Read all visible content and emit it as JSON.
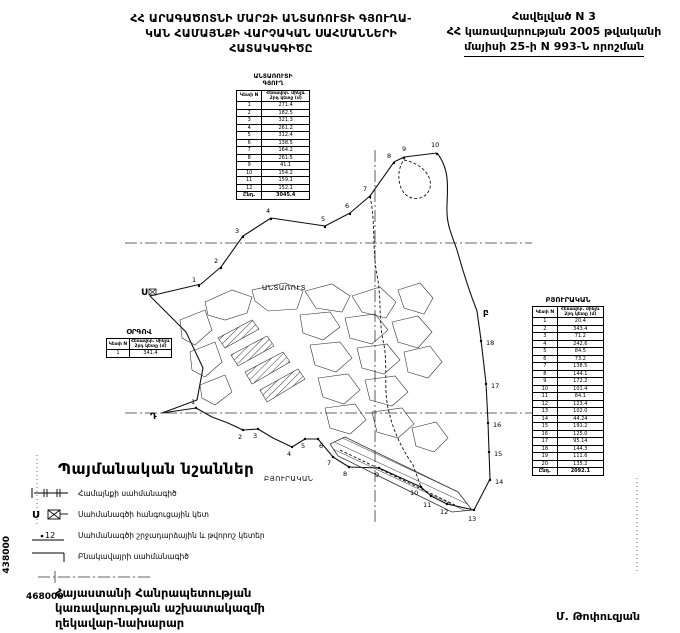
{
  "header": {
    "title_lines": [
      "ՀՀ ԱՐԱԳԱԾՈՏՆԻ ՄԱՐԶԻ ԱՆՏԱՌՈՒՏԻ ԳՅՈՒՂԱ-",
      "ԿԱՆ ՀԱՄԱՅՆՔԻ ՎԱՐՉԱԿԱՆ ՍԱՀՄԱՆՆԵՐԻ",
      "ՀԱՏԱԿԱԳԻԾԸ"
    ],
    "annex_lines": [
      "Հավելված N 3",
      "ՀՀ կառավարության 2005 թվականի",
      "մայիսի 25-ի N 993-Ն որոշման"
    ]
  },
  "tables": {
    "col_point": "Կետի N",
    "col_dist": "Հեռավոր. մինչև 2րդ կետը (մ)",
    "total_label": "Ընդ.",
    "north": {
      "title_lines": [
        "ԱՆՏԱՌՈՒՏԻ",
        "ԳՅՈՒՂ"
      ],
      "rows": [
        [
          "1",
          "271.4"
        ],
        [
          "2",
          "182.5"
        ],
        [
          "3",
          "321.3"
        ],
        [
          "4",
          "261.2"
        ],
        [
          "5",
          "312.4"
        ],
        [
          "6",
          "138.5"
        ],
        [
          "7",
          "164.2"
        ],
        [
          "8",
          "261.5"
        ],
        [
          "9",
          "41.1"
        ],
        [
          "10",
          "154.2"
        ],
        [
          "11",
          "159.1"
        ],
        [
          "12",
          "152.1"
        ]
      ],
      "total": "3045.4"
    },
    "orgov": {
      "title": "ՕՐԳՈՎ",
      "rows": [
        [
          "1",
          "341.4"
        ]
      ]
    },
    "byurakan": {
      "title": "ԲՅՈՒՐԱԿԱՆ",
      "rows": [
        [
          "1",
          "20.4"
        ],
        [
          "2",
          "343.4"
        ],
        [
          "3",
          "71.2"
        ],
        [
          "4",
          "242.6"
        ],
        [
          "5",
          "84.5"
        ],
        [
          "6",
          "73.2"
        ],
        [
          "7",
          "138.5"
        ],
        [
          "8",
          "144.1"
        ],
        [
          "9",
          "172.2"
        ],
        [
          "10",
          "101.4"
        ],
        [
          "11",
          "84.1"
        ],
        [
          "12",
          "123.4"
        ],
        [
          "13",
          "102.0"
        ],
        [
          "14",
          "44.24"
        ],
        [
          "15",
          "191.2"
        ],
        [
          "16",
          "125.0"
        ],
        [
          "17",
          "95.14"
        ],
        [
          "18",
          "144.3"
        ],
        [
          "19",
          "111.6"
        ],
        [
          "20",
          "135.2"
        ]
      ],
      "total": "2092.1"
    }
  },
  "map": {
    "village_label": "ԱՆՏԱՌՈՒՏ",
    "byurakan_label": "ԲՅՈՒՐԱԿԱՆ",
    "coord_vertical": "438000",
    "coord_horizontal": "468000",
    "junctions": [
      {
        "letter": "U",
        "x": 141,
        "y": 295
      },
      {
        "letter": "բ",
        "x": 483,
        "y": 315
      },
      {
        "letter": "Դ",
        "x": 150,
        "y": 419
      }
    ],
    "points": [
      {
        "n": "1",
        "x": 199,
        "y": 286,
        "tx": 192,
        "ty": 282
      },
      {
        "n": "2",
        "x": 221,
        "y": 268,
        "tx": 214,
        "ty": 263
      },
      {
        "n": "3",
        "x": 243,
        "y": 237,
        "tx": 235,
        "ty": 233
      },
      {
        "n": "4",
        "x": 271,
        "y": 219,
        "tx": 266,
        "ty": 213
      },
      {
        "n": "5",
        "x": 325,
        "y": 227,
        "tx": 321,
        "ty": 221
      },
      {
        "n": "6",
        "x": 350,
        "y": 214,
        "tx": 345,
        "ty": 208
      },
      {
        "n": "7",
        "x": 370,
        "y": 197,
        "tx": 363,
        "ty": 191
      },
      {
        "n": "8",
        "x": 394,
        "y": 163,
        "tx": 387,
        "ty": 158
      },
      {
        "n": "9",
        "x": 404,
        "y": 158,
        "tx": 402,
        "ty": 151
      },
      {
        "n": "10",
        "x": 437,
        "y": 154,
        "tx": 431,
        "ty": 147
      },
      {
        "n": "18",
        "x": 481,
        "y": 341,
        "tx": 486,
        "ty": 345
      },
      {
        "n": "17",
        "x": 486,
        "y": 384,
        "tx": 491,
        "ty": 388
      },
      {
        "n": "16",
        "x": 488,
        "y": 423,
        "tx": 493,
        "ty": 427
      },
      {
        "n": "15",
        "x": 489,
        "y": 452,
        "tx": 494,
        "ty": 456
      },
      {
        "n": "14",
        "x": 490,
        "y": 480,
        "tx": 495,
        "ty": 484
      },
      {
        "n": "13",
        "x": 474,
        "y": 510,
        "tx": 468,
        "ty": 521
      },
      {
        "n": "12",
        "x": 447,
        "y": 504,
        "tx": 440,
        "ty": 514
      },
      {
        "n": "11",
        "x": 431,
        "y": 496,
        "tx": 423,
        "ty": 507
      },
      {
        "n": "10",
        "x": 421,
        "y": 487,
        "tx": 410,
        "ty": 495
      },
      {
        "n": "9",
        "x": 379,
        "y": 468,
        "tx": 375,
        "ty": 477
      },
      {
        "n": "8",
        "x": 349,
        "y": 467,
        "tx": 343,
        "ty": 476
      },
      {
        "n": "7",
        "x": 333,
        "y": 457,
        "tx": 327,
        "ty": 465
      },
      {
        "n": "6",
        "x": 318,
        "y": 439,
        "tx": 319,
        "ty": 448
      },
      {
        "n": "5",
        "x": 305,
        "y": 439,
        "tx": 301,
        "ty": 448
      },
      {
        "n": "4",
        "x": 292,
        "y": 447,
        "tx": 287,
        "ty": 456
      },
      {
        "n": "3",
        "x": 258,
        "y": 429,
        "tx": 253,
        "ty": 438
      },
      {
        "n": "2",
        "x": 243,
        "y": 430,
        "tx": 238,
        "ty": 439
      },
      {
        "n": "1",
        "x": 196,
        "y": 408,
        "tx": 191,
        "ty": 404
      }
    ]
  },
  "legend": {
    "title": "Պայմանական նշաններ",
    "junction_letter": "U",
    "turning_point_number": "12",
    "items": [
      {
        "label": "Համայնքի սահմանագիծ"
      },
      {
        "label": "Սահմանագծի հանգուցային կետ"
      },
      {
        "label": "Սահմանագծի շրջադարձային և թվորոշ կետեր"
      },
      {
        "label": "Բնակավայրի սահմանագիծ"
      }
    ]
  },
  "footer": {
    "signature_lines": [
      "Հայաստանի Հանրապետության",
      "կառավարության աշխատակազմի",
      "ղեկավար-նախարար"
    ],
    "signatory": "Մ. Թոփուզյան"
  }
}
